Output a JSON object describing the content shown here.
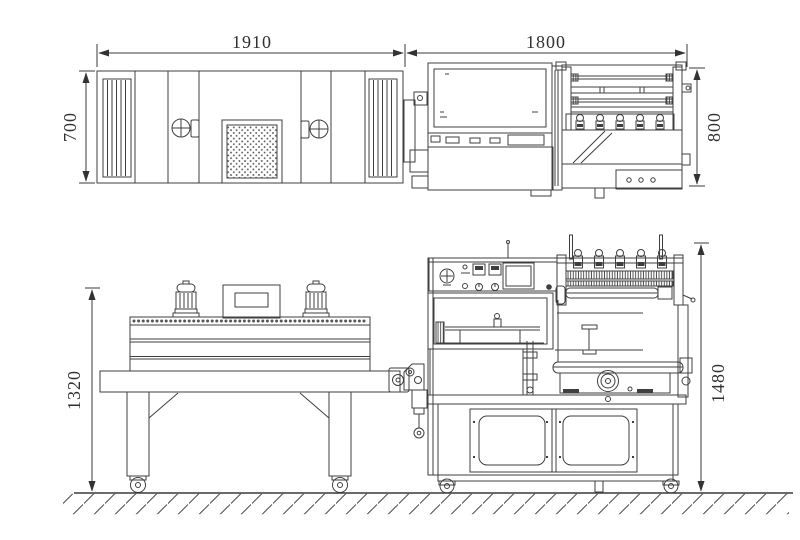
{
  "page": {
    "background": "#ffffff"
  },
  "drawing": {
    "line_color": "#3f3f3f",
    "dimension_color": "#303030",
    "dimensions": {
      "tunnel_top_width": "1910",
      "sealer_top_width": "1800",
      "tunnel_top_depth": "700",
      "sealer_top_depth": "800",
      "tunnel_side_height": "1320",
      "sealer_side_height": "1480"
    }
  }
}
